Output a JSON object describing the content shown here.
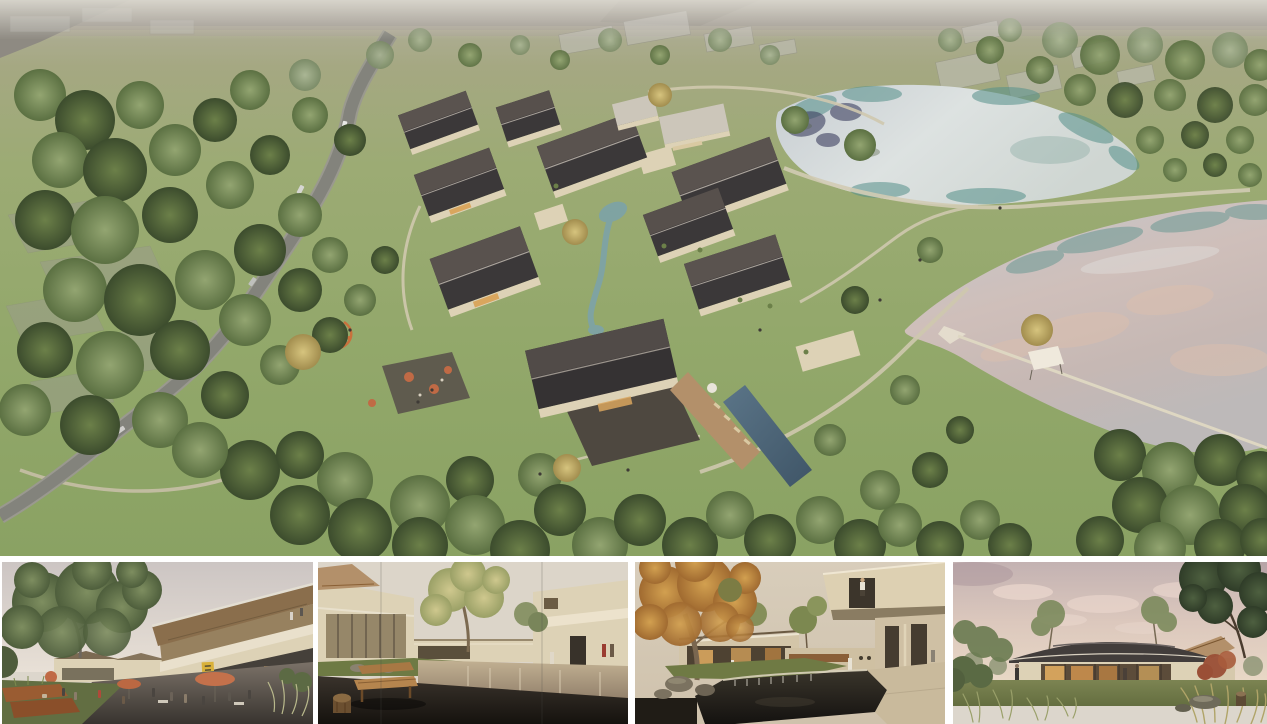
{
  "page": {
    "type": "architectural-rendering-presentation-board",
    "background": "#ffffff"
  },
  "hero": {
    "label": "aerial-masterplan-rendering",
    "description": "Aerial bird's-eye rendering of a lakeside village resort: clusters of dark pitched-roof houses with cream walls arranged around a winding turquoise stream, cafe terraces with orange parasols, a playground, an infinity pool with timber sun deck, a curving grey road through meadows and dense tree groves, translucent future-phase buildings at the horizon, and two silvery ponds divided by a grassy dam crossed by a thin footbridge."
  },
  "thumbnails": [
    {
      "label": "street-plaza-rendering",
      "description": "Eye-level view of the village high street: a two-storey timber-and-glass building with a mono-pitch roof and yellow shop sign, cafe terrace with salmon parasols, people strolling past corten planters beneath a large green tree."
    },
    {
      "label": "courtyard-pond-rendering",
      "description": "Courtyard with a shallow reflecting pond between cream houses, a pale yellow-green tree, and a wooden bench with a log stool on a dark stone terrace in the foreground."
    },
    {
      "label": "autumn-waterfall-courtyard-rendering",
      "description": "Garden court with a golden autumn tree, a dark pond spilling over a stone weir, glazed pavilions with warm interior light, and a cantilevered cream roof terrace with a visitor standing above."
    },
    {
      "label": "dusk-pavilion-rendering",
      "description": "Single-storey glass pavilion with a low dark hipped roof glowing warmly at dusk under a pink cloud-streaked sky, framed by lawn, tall wild grasses, a red maple and mature trees."
    }
  ],
  "palette": {
    "bg": "#ffffff",
    "haze": "#d8d6cc",
    "field": "#99938a",
    "grass_hi": "#a3ab7c",
    "grass_lo": "#8aa263",
    "road": "#83837c",
    "road_edge": "#99988f",
    "path": "#cfc8ae",
    "roof_hi": "#5a534f",
    "roof_lo": "#3b3839",
    "roof_light": "#ccc6ba",
    "wall": "#ddd2b6",
    "wood": "#b3906a",
    "stone": "#4e4840",
    "stream": "#7fa3a2",
    "lake_silver": "#cdd2d5",
    "lake_pink": "#cfbcb6",
    "lake_teal": "#55908a",
    "navy_reflection": "#3d4060",
    "pool": "#53697b",
    "tree_hi": "#93a571",
    "tree_lo": "#5b7042",
    "tree_dark": "#3c4c2d",
    "tree_yellow": "#c3ae62",
    "autumn": "#c28f4a",
    "umbrella": "#c06a45",
    "sign_yellow": "#d9b13a",
    "corten": "#9a5c32",
    "sky_warm": "#e2d0c4",
    "sky_mauve": "#a9949a",
    "terrace_dark": "#241f1a",
    "bench": "#b5854e",
    "maple": "#9a4f36",
    "glow": "#d9a65e",
    "ghost": "#c2c0ba"
  }
}
